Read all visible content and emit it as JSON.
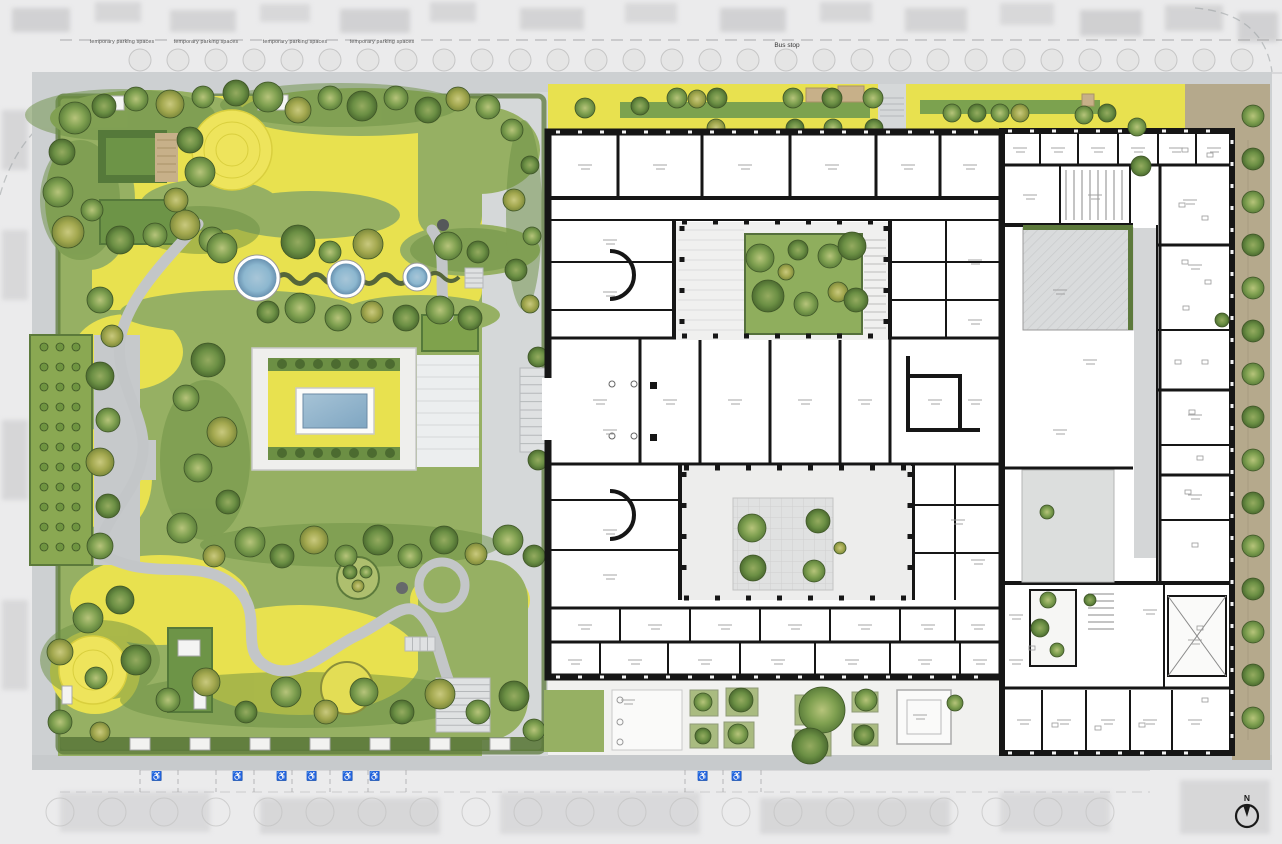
{
  "labels": {
    "bus_stop": "Bus stop",
    "north_indicator": "N",
    "parking_label": "temporary parking spaces",
    "parking_label_positions": [
      [
        122,
        43
      ],
      [
        206,
        43
      ],
      [
        295,
        43
      ],
      [
        382,
        43
      ]
    ],
    "accessible_icon": "♿",
    "accessible_positions": [
      [
        157,
        779
      ],
      [
        238,
        779
      ],
      [
        282,
        779
      ],
      [
        312,
        779
      ],
      [
        348,
        779
      ],
      [
        375,
        779
      ],
      [
        703,
        779
      ],
      [
        737,
        779
      ]
    ]
  },
  "colors": {
    "context_gray": "#ebebec",
    "sidewalk_gray": "#cdd0d2",
    "plaza_gray": "#d5d8d9",
    "path_gray": "#c3c6c8",
    "lawn_yellow": "#e8e14f",
    "mound_yellow": "#eee45c",
    "grass_green": "#96b063",
    "hedge_dark": "#5c7a3b",
    "foliage_dark": "#6c8f44",
    "pond_blue": "#8cb7cf",
    "pond_deep": "#6d96b4",
    "pool_blue": "#93b6cd",
    "wall_black": "#161616",
    "courtyard_paving": "#ededec",
    "hatch_gray": "#d9dbdc",
    "tan_strip": "#b5a98c",
    "deck_tan": "#c7b089",
    "tree_outline": "#3f5627",
    "mark_gray": "#9b9b9b"
  },
  "plan": {
    "garden_trees": [
      [
        75,
        118,
        16,
        1
      ],
      [
        104,
        106,
        12,
        2
      ],
      [
        136,
        99,
        12,
        1
      ],
      [
        170,
        104,
        14,
        3
      ],
      [
        203,
        97,
        11,
        1
      ],
      [
        236,
        93,
        13,
        2
      ],
      [
        62,
        152,
        13,
        2
      ],
      [
        58,
        192,
        15,
        1
      ],
      [
        68,
        232,
        16,
        3
      ],
      [
        92,
        210,
        11,
        1
      ],
      [
        120,
        240,
        14,
        2
      ],
      [
        155,
        235,
        12,
        1
      ],
      [
        185,
        225,
        15,
        3
      ],
      [
        212,
        240,
        13,
        1
      ],
      [
        268,
        97,
        15,
        1
      ],
      [
        298,
        110,
        13,
        3
      ],
      [
        330,
        98,
        12,
        1
      ],
      [
        362,
        106,
        15,
        2
      ],
      [
        396,
        98,
        12,
        1
      ],
      [
        428,
        110,
        13,
        2
      ],
      [
        458,
        99,
        12,
        3
      ],
      [
        488,
        107,
        12,
        1
      ],
      [
        190,
        140,
        13,
        2
      ],
      [
        200,
        172,
        15,
        1
      ],
      [
        176,
        200,
        12,
        3
      ],
      [
        222,
        248,
        15,
        1
      ],
      [
        298,
        242,
        17,
        2
      ],
      [
        330,
        252,
        11,
        1
      ],
      [
        368,
        244,
        15,
        3
      ],
      [
        300,
        308,
        15,
        1
      ],
      [
        268,
        312,
        11,
        2
      ],
      [
        338,
        318,
        13,
        1
      ],
      [
        372,
        312,
        11,
        3
      ],
      [
        406,
        318,
        13,
        2
      ],
      [
        440,
        310,
        14,
        1
      ],
      [
        470,
        318,
        12,
        2
      ],
      [
        448,
        246,
        14,
        1
      ],
      [
        478,
        252,
        11,
        2
      ],
      [
        100,
        300,
        13,
        1
      ],
      [
        112,
        336,
        11,
        3
      ],
      [
        100,
        376,
        14,
        2
      ],
      [
        108,
        420,
        12,
        1
      ],
      [
        100,
        462,
        14,
        3
      ],
      [
        108,
        506,
        12,
        2
      ],
      [
        100,
        546,
        13,
        1
      ],
      [
        208,
        360,
        17,
        2
      ],
      [
        186,
        398,
        13,
        1
      ],
      [
        222,
        432,
        15,
        3
      ],
      [
        198,
        468,
        14,
        1
      ],
      [
        228,
        502,
        12,
        2
      ],
      [
        182,
        528,
        15,
        1
      ],
      [
        214,
        556,
        11,
        3
      ],
      [
        250,
        542,
        15,
        1
      ],
      [
        282,
        556,
        12,
        2
      ],
      [
        314,
        540,
        14,
        3
      ],
      [
        346,
        556,
        11,
        1
      ],
      [
        378,
        540,
        15,
        2
      ],
      [
        410,
        556,
        12,
        1
      ],
      [
        444,
        540,
        14,
        2
      ],
      [
        476,
        554,
        11,
        3
      ],
      [
        508,
        540,
        15,
        1
      ],
      [
        534,
        556,
        11,
        2
      ],
      [
        120,
        600,
        14,
        2
      ],
      [
        88,
        618,
        15,
        1
      ],
      [
        60,
        652,
        13,
        3
      ],
      [
        96,
        678,
        11,
        1
      ],
      [
        136,
        660,
        15,
        2
      ],
      [
        168,
        700,
        12,
        1
      ],
      [
        206,
        682,
        14,
        3
      ],
      [
        246,
        712,
        11,
        2
      ],
      [
        286,
        692,
        15,
        1
      ],
      [
        326,
        712,
        12,
        3
      ],
      [
        364,
        692,
        14,
        1
      ],
      [
        402,
        712,
        12,
        2
      ],
      [
        440,
        694,
        15,
        3
      ],
      [
        478,
        712,
        12,
        1
      ],
      [
        514,
        696,
        15,
        2
      ],
      [
        60,
        722,
        12,
        1
      ],
      [
        100,
        732,
        10,
        3
      ],
      [
        534,
        730,
        11,
        1
      ],
      [
        350,
        572,
        7,
        2
      ],
      [
        366,
        572,
        6,
        1
      ],
      [
        358,
        586,
        6,
        3
      ]
    ],
    "plaza_trees": [
      [
        512,
        130,
        11,
        1
      ],
      [
        530,
        165,
        9,
        2
      ],
      [
        514,
        200,
        11,
        3
      ],
      [
        532,
        236,
        9,
        1
      ],
      [
        516,
        270,
        11,
        2
      ],
      [
        530,
        304,
        9,
        3
      ],
      [
        538,
        357,
        10,
        2
      ],
      [
        538,
        460,
        10,
        2
      ],
      [
        585,
        108,
        10,
        1
      ],
      [
        640,
        106,
        9,
        2
      ],
      [
        677,
        98,
        10,
        1
      ],
      [
        697,
        99,
        9,
        3
      ],
      [
        717,
        98,
        10,
        2
      ],
      [
        793,
        98,
        10,
        1
      ],
      [
        832,
        98,
        10,
        2
      ],
      [
        873,
        98,
        10,
        1
      ],
      [
        716,
        128,
        9,
        3
      ],
      [
        795,
        128,
        9,
        2
      ],
      [
        833,
        128,
        9,
        1
      ],
      [
        874,
        128,
        9,
        2
      ],
      [
        952,
        113,
        9,
        1
      ],
      [
        977,
        113,
        9,
        2
      ],
      [
        1000,
        113,
        9,
        1
      ],
      [
        1020,
        113,
        9,
        3
      ],
      [
        1084,
        115,
        9,
        1
      ],
      [
        1107,
        113,
        9,
        2
      ]
    ],
    "upper_courtyard_trees": [
      [
        760,
        258,
        14,
        1
      ],
      [
        798,
        250,
        10,
        2
      ],
      [
        830,
        256,
        12,
        1
      ],
      [
        852,
        246,
        14,
        2
      ],
      [
        768,
        296,
        16,
        2
      ],
      [
        806,
        304,
        12,
        1
      ],
      [
        838,
        292,
        10,
        3
      ],
      [
        856,
        300,
        12,
        2
      ],
      [
        786,
        272,
        8,
        3
      ]
    ],
    "lower_courtyard_trees": [
      [
        752,
        528,
        14,
        1
      ],
      [
        818,
        521,
        12,
        2
      ],
      [
        753,
        568,
        13,
        2
      ],
      [
        814,
        571,
        11,
        1
      ],
      [
        840,
        548,
        6,
        3
      ]
    ],
    "forecourt_trees": [
      [
        703,
        702,
        9,
        1
      ],
      [
        741,
        700,
        12,
        2
      ],
      [
        703,
        736,
        8,
        2
      ],
      [
        738,
        734,
        10,
        1
      ],
      [
        822,
        710,
        23,
        1
      ],
      [
        810,
        746,
        18,
        2
      ],
      [
        866,
        700,
        11,
        1
      ],
      [
        864,
        735,
        10,
        2
      ],
      [
        955,
        703,
        8,
        1
      ]
    ],
    "wing_trees": [
      [
        1048,
        600,
        8,
        1
      ],
      [
        1040,
        628,
        9,
        2
      ],
      [
        1057,
        650,
        7,
        1
      ],
      [
        1090,
        600,
        6,
        2
      ],
      [
        1047,
        512,
        7,
        1
      ],
      [
        1222,
        320,
        7,
        2
      ],
      [
        1137,
        127,
        9,
        1
      ],
      [
        1141,
        166,
        10,
        2
      ]
    ],
    "right_strip_trees": {
      "x": 1253,
      "y_start": 116,
      "step": 43,
      "count": 15,
      "r": 11
    },
    "orchard": {
      "x0": 44,
      "y0": 347,
      "cols": 3,
      "rows": 11,
      "dx": 16,
      "dy": 20,
      "r": 4
    },
    "ponds": [
      [
        257,
        278,
        19
      ],
      [
        346,
        279,
        15
      ],
      [
        417,
        277,
        10
      ]
    ],
    "pool": {
      "x": 296,
      "y": 388,
      "w": 78,
      "h": 46
    },
    "fence_posts": [
      [
        130,
        738
      ],
      [
        190,
        738
      ],
      [
        250,
        738
      ],
      [
        310,
        738
      ],
      [
        370,
        738
      ],
      [
        430,
        738
      ],
      [
        490,
        738
      ]
    ],
    "room_marks": [
      [
        585,
        165
      ],
      [
        660,
        165
      ],
      [
        745,
        165
      ],
      [
        832,
        165
      ],
      [
        908,
        165
      ],
      [
        970,
        165
      ],
      [
        610,
        240
      ],
      [
        610,
        292
      ],
      [
        610,
        430
      ],
      [
        610,
        530
      ],
      [
        610,
        575
      ],
      [
        600,
        400
      ],
      [
        670,
        400
      ],
      [
        735,
        400
      ],
      [
        805,
        400
      ],
      [
        865,
        400
      ],
      [
        935,
        400
      ],
      [
        975,
        400
      ],
      [
        975,
        260
      ],
      [
        975,
        320
      ],
      [
        958,
        520
      ],
      [
        978,
        560
      ],
      [
        585,
        625
      ],
      [
        655,
        625
      ],
      [
        725,
        625
      ],
      [
        795,
        625
      ],
      [
        865,
        625
      ],
      [
        928,
        625
      ],
      [
        978,
        625
      ],
      [
        575,
        660
      ],
      [
        635,
        660
      ],
      [
        705,
        660
      ],
      [
        778,
        660
      ],
      [
        852,
        660
      ],
      [
        925,
        660
      ],
      [
        980,
        660
      ],
      [
        1020,
        148
      ],
      [
        1058,
        148
      ],
      [
        1098,
        148
      ],
      [
        1138,
        148
      ],
      [
        1176,
        148
      ],
      [
        1214,
        148
      ],
      [
        1030,
        195
      ],
      [
        1095,
        195
      ],
      [
        1190,
        200
      ],
      [
        1060,
        290
      ],
      [
        1090,
        360
      ],
      [
        1060,
        430
      ],
      [
        1195,
        265
      ],
      [
        1195,
        415
      ],
      [
        1195,
        495
      ],
      [
        1016,
        615
      ],
      [
        1150,
        610
      ],
      [
        1016,
        660
      ],
      [
        1024,
        720
      ],
      [
        1064,
        720
      ],
      [
        1108,
        720
      ],
      [
        1150,
        720
      ],
      [
        1195,
        720
      ],
      [
        1195,
        640
      ],
      [
        628,
        700
      ],
      [
        920,
        715
      ]
    ],
    "desk_marks": [
      [
        1185,
        150
      ],
      [
        1210,
        155
      ],
      [
        1182,
        205
      ],
      [
        1205,
        218
      ],
      [
        1185,
        262
      ],
      [
        1208,
        282
      ],
      [
        1186,
        308
      ],
      [
        1178,
        362
      ],
      [
        1205,
        362
      ],
      [
        1192,
        412
      ],
      [
        1200,
        458
      ],
      [
        1188,
        492
      ],
      [
        1195,
        545
      ],
      [
        1055,
        725
      ],
      [
        1098,
        728
      ],
      [
        1142,
        725
      ],
      [
        1200,
        628
      ],
      [
        1032,
        648
      ],
      [
        1205,
        700
      ]
    ]
  }
}
